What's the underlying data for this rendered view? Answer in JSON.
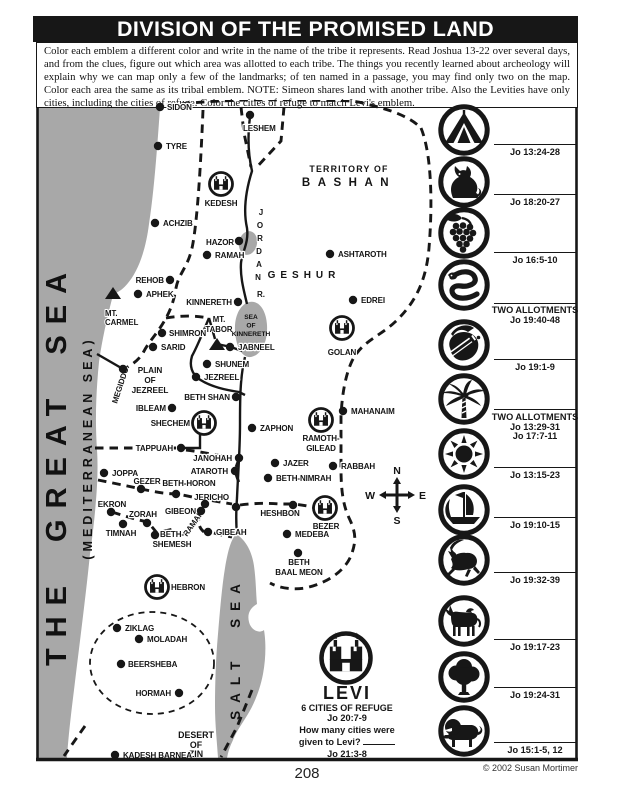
{
  "title": "DIVISION OF THE PROMISED LAND",
  "instructions": "Color each emblem a different color and write in the name of the tribe it represents. Read Joshua 13-22 over several days, and from the clues, figure out which area was allotted to each tribe. The things you recently learned about archeology will explain why we can map only a few of the landmarks; of ten named in a passage, you may find only two on the map.  Color each area the same as its tribal emblem. NOTE: Simeon shares land with another tribe. Also the Levities have only cities, including the cities of refuge. Color the cities of refuge to match Levi's emblem.",
  "footer": {
    "page_number": "208",
    "copyright": "© 2002 Susan Mortimer"
  },
  "colors": {
    "ink": "#171717",
    "sea_gray": "#a8a8a8",
    "paper": "#ffffff"
  },
  "map": {
    "great_sea": {
      "title": "THE  GREAT  SEA",
      "subtitle": "(MEDITERRANEAN   SEA)"
    },
    "salt_sea_label": "SALT  SEA",
    "sea_of_kinnereth": [
      "SEA",
      "OF",
      "KINNERETH"
    ],
    "jordan_letters": [
      [
        "J",
        261,
        215
      ],
      [
        "O",
        260,
        228
      ],
      [
        "R",
        260,
        241
      ],
      [
        "D",
        259,
        254
      ],
      [
        "A",
        259,
        267
      ],
      [
        "N",
        258,
        280
      ],
      [
        "R.",
        261,
        297
      ]
    ],
    "regions": [
      {
        "t": "TERRITORY OF",
        "x": 349,
        "y": 172,
        "s": 8.8,
        "ls": 1.2,
        "a": "middle"
      },
      {
        "t": "BASHAN",
        "x": 349,
        "y": 186,
        "s": 11.5,
        "ls": 7.5,
        "a": "middle"
      },
      {
        "t": "GESHUR",
        "x": 304,
        "y": 278,
        "s": 10,
        "ls": 5,
        "a": "middle"
      },
      {
        "t": "PLAIN",
        "x": 150,
        "y": 373,
        "s": 8.2,
        "ls": 0,
        "a": "middle"
      },
      {
        "t": "OF",
        "x": 150,
        "y": 383,
        "s": 8.2,
        "ls": 0,
        "a": "middle"
      },
      {
        "t": "JEZREEL",
        "x": 150,
        "y": 393,
        "s": 8.2,
        "ls": 0,
        "a": "middle"
      },
      {
        "t": "MT.",
        "x": 105,
        "y": 316,
        "s": 7.8,
        "ls": 0,
        "a": "start"
      },
      {
        "t": "CARMEL",
        "x": 105,
        "y": 325,
        "s": 7.8,
        "ls": 0,
        "a": "start"
      },
      {
        "t": "MT.",
        "x": 219,
        "y": 322,
        "s": 7.8,
        "ls": 0,
        "a": "middle"
      },
      {
        "t": "TABOR",
        "x": 219,
        "y": 332,
        "s": 7.8,
        "ls": 0,
        "a": "middle"
      },
      {
        "t": "DESERT",
        "x": 196,
        "y": 738,
        "s": 8.8,
        "ls": 0,
        "a": "middle"
      },
      {
        "t": "OF",
        "x": 196,
        "y": 748,
        "s": 8.8,
        "ls": 0,
        "a": "middle"
      },
      {
        "t": "ZIN",
        "x": 196,
        "y": 757,
        "s": 8.8,
        "ls": 0,
        "a": "middle"
      }
    ],
    "cities": [
      {
        "n": "SIDON",
        "x": 160,
        "y": 107,
        "lx": 167,
        "ly": 110,
        "a": "start"
      },
      {
        "n": "LESHEM",
        "x": 250,
        "y": 115,
        "lx": 243,
        "ly": 131,
        "a": "start"
      },
      {
        "n": "TYRE",
        "x": 158,
        "y": 146,
        "lx": 166,
        "ly": 149,
        "a": "start"
      },
      {
        "n": "ACHZIB",
        "x": 155,
        "y": 223,
        "lx": 163,
        "ly": 226,
        "a": "start"
      },
      {
        "n": "HAZOR",
        "x": 239,
        "y": 241,
        "lx": 234,
        "ly": 245,
        "a": "end"
      },
      {
        "n": "RAMAH",
        "x": 207,
        "y": 255,
        "lx": 215,
        "ly": 258,
        "a": "start"
      },
      {
        "n": "ASHTAROTH",
        "x": 330,
        "y": 254,
        "lx": 338,
        "ly": 257,
        "a": "start"
      },
      {
        "n": "REHOB",
        "x": 170,
        "y": 280,
        "lx": 164,
        "ly": 283,
        "a": "end"
      },
      {
        "n": "APHEK",
        "x": 138,
        "y": 294,
        "lx": 146,
        "ly": 297,
        "a": "start"
      },
      {
        "n": "EDREI",
        "x": 353,
        "y": 300,
        "lx": 361,
        "ly": 303,
        "a": "start"
      },
      {
        "n": "KINNERETH",
        "x": 238,
        "y": 302,
        "lx": 232,
        "ly": 305,
        "a": "end"
      },
      {
        "n": "SHIMRON",
        "x": 162,
        "y": 333,
        "lx": 169,
        "ly": 336,
        "a": "start"
      },
      {
        "n": "SARID",
        "x": 153,
        "y": 347,
        "lx": 161,
        "ly": 350,
        "a": "start"
      },
      {
        "n": "JABNEEL",
        "x": 230,
        "y": 347,
        "lx": 238,
        "ly": 350,
        "a": "start"
      },
      {
        "n": "SHUNEM",
        "x": 207,
        "y": 364,
        "lx": 215,
        "ly": 367,
        "a": "start"
      },
      {
        "n": "JEZREEL",
        "x": 196,
        "y": 377,
        "lx": 204,
        "ly": 380,
        "a": "start"
      },
      {
        "n": "MEGIDDO",
        "x": 123,
        "y": 369,
        "lx": 117,
        "ly": 404,
        "a": "start",
        "r": -72
      },
      {
        "n": "BETH SHAN",
        "x": 236,
        "y": 397,
        "lx": 230,
        "ly": 400,
        "a": "end"
      },
      {
        "n": "IBLEAM",
        "x": 172,
        "y": 408,
        "lx": 166,
        "ly": 411,
        "a": "end"
      },
      {
        "n": "ZAPHON",
        "x": 252,
        "y": 428,
        "lx": 260,
        "ly": 431,
        "a": "start"
      },
      {
        "n": "MAHANAIM",
        "x": 343,
        "y": 411,
        "lx": 351,
        "ly": 414,
        "a": "start"
      },
      {
        "n": "TAPPUAH",
        "x": 181,
        "y": 448,
        "lx": 173,
        "ly": 451,
        "a": "end"
      },
      {
        "n": "JANOHAH",
        "x": 239,
        "y": 458,
        "lx": 232,
        "ly": 461,
        "a": "end"
      },
      {
        "n": "ATAROTH",
        "x": 235,
        "y": 471,
        "lx": 228,
        "ly": 474,
        "a": "end"
      },
      {
        "n": "JAZER",
        "x": 275,
        "y": 463,
        "lx": 283,
        "ly": 466,
        "a": "start"
      },
      {
        "n": "RABBAH",
        "x": 333,
        "y": 466,
        "lx": 341,
        "ly": 469,
        "a": "start"
      },
      {
        "n": "JOPPA",
        "x": 104,
        "y": 473,
        "lx": 112,
        "ly": 476,
        "a": "start"
      },
      {
        "n": "GEZER",
        "x": 141,
        "y": 489,
        "lx": 147,
        "ly": 484,
        "a": "middle"
      },
      {
        "n": "BETH-HORON",
        "x": 176,
        "y": 494,
        "lx": 189,
        "ly": 486,
        "a": "middle"
      },
      {
        "n": "BETH-NIMRAH",
        "x": 268,
        "y": 478,
        "lx": 276,
        "ly": 481,
        "a": "start"
      },
      {
        "n": "JERICHO",
        "x": 236,
        "y": 507,
        "lx": 229,
        "ly": 500,
        "a": "end"
      },
      {
        "n": "EKRON",
        "x": 111,
        "y": 512,
        "lx": 112,
        "ly": 507,
        "a": "middle"
      },
      {
        "n": "ZORAH",
        "x": 147,
        "y": 523,
        "lx": 143,
        "ly": 517,
        "a": "middle"
      },
      {
        "n": "GIBEON",
        "x": 201,
        "y": 511,
        "lx": 196,
        "ly": 514,
        "a": "end"
      },
      {
        "n": "RAMAH",
        "x": 205,
        "y": 504,
        "lx": 187,
        "ly": 537,
        "a": "start",
        "r": -55
      },
      {
        "n": "HESHBON",
        "x": 293,
        "y": 505,
        "lx": 280,
        "ly": 516,
        "a": "middle"
      },
      {
        "n": "TIMNAH",
        "x": 123,
        "y": 524,
        "lx": 121,
        "ly": 536,
        "a": "middle"
      },
      {
        "n": "BETH-SHEMESH",
        "x": 155,
        "y": 535,
        "a": "middle",
        "lines": [
          [
            "BETH-",
            172,
            537
          ],
          [
            "SHEMESH",
            172,
            547
          ]
        ]
      },
      {
        "n": "GIBEAH",
        "x": 208,
        "y": 532,
        "lx": 216,
        "ly": 535,
        "a": "start"
      },
      {
        "n": "MEDEBA",
        "x": 287,
        "y": 534,
        "lx": 295,
        "ly": 537,
        "a": "start"
      },
      {
        "n": "BETH BAAL MEON",
        "x": 298,
        "y": 553,
        "a": "middle",
        "lines": [
          [
            "BETH",
            299,
            565
          ],
          [
            "BAAL MEON",
            299,
            575
          ]
        ]
      },
      {
        "n": "ZIKLAG",
        "x": 117,
        "y": 628,
        "lx": 125,
        "ly": 631,
        "a": "start"
      },
      {
        "n": "MOLADAH",
        "x": 139,
        "y": 639,
        "lx": 147,
        "ly": 642,
        "a": "start"
      },
      {
        "n": "BEERSHEBA",
        "x": 121,
        "y": 664,
        "lx": 128,
        "ly": 667,
        "a": "start"
      },
      {
        "n": "HORMAH",
        "x": 179,
        "y": 693,
        "lx": 171,
        "ly": 696,
        "a": "end"
      },
      {
        "n": "KADESH BARNEA",
        "x": 115,
        "y": 755,
        "lx": 123,
        "ly": 758,
        "a": "start"
      }
    ],
    "refuge_cities": [
      {
        "n": "KEDESH",
        "x": 221,
        "y": 184,
        "lines": [
          [
            "KEDESH",
            221,
            206
          ]
        ]
      },
      {
        "n": "GOLAN",
        "x": 342,
        "y": 328,
        "lines": [
          [
            "GOLAN",
            342,
            355
          ]
        ]
      },
      {
        "n": "SHECHEM",
        "x": 204,
        "y": 423,
        "lines": [
          [
            "SHECHEM",
            190,
            426
          ]
        ],
        "a": "end"
      },
      {
        "n": "RAMOTH-GILEAD",
        "x": 321,
        "y": 420,
        "lines": [
          [
            "RAMOTH-",
            321,
            441
          ],
          [
            "GILEAD",
            321,
            451
          ]
        ]
      },
      {
        "n": "BEZER",
        "x": 325,
        "y": 508,
        "lines": [
          [
            "BEZER",
            326,
            529
          ]
        ]
      },
      {
        "n": "HEBRON",
        "x": 157,
        "y": 587,
        "lines": [
          [
            "HEBRON",
            171,
            590
          ]
        ],
        "a": "start"
      }
    ],
    "mountains": [
      {
        "x": 113,
        "y": 294
      },
      {
        "x": 217,
        "y": 345
      }
    ],
    "compass": {
      "n": "N",
      "w": "W",
      "e": "E",
      "s": "S",
      "x": 397,
      "y": 495
    }
  },
  "emblems": [
    {
      "icon": "tent-icon",
      "cy": 130,
      "line_y": 144,
      "texts": [
        {
          "t": "Jo 13:24-28",
          "y": 155
        }
      ]
    },
    {
      "icon": "wolf-icon",
      "cy": 182,
      "line_y": 194,
      "texts": [
        {
          "t": "Jo 18:20-27",
          "y": 205
        }
      ]
    },
    {
      "icon": "grapes-icon",
      "cy": 233,
      "line_y": 252,
      "texts": [
        {
          "t": "Jo 16:5-10",
          "y": 263
        }
      ]
    },
    {
      "icon": "snake-icon",
      "cy": 285,
      "line_y": 303,
      "texts": [
        {
          "t": "TWO ALLOTMENTS",
          "y": 313
        },
        {
          "t": "Jo 19:40-48",
          "y": 323
        }
      ]
    },
    {
      "icon": "sword-icon",
      "cy": 345,
      "line_y": 359,
      "texts": [
        {
          "t": "Jo 19:1-9",
          "y": 370
        }
      ]
    },
    {
      "icon": "palm-tree-icon",
      "cy": 399,
      "line_y": 409,
      "texts": [
        {
          "t": "TWO ALLOTMENTS",
          "y": 420
        },
        {
          "t": "Jo 13:29-31",
          "y": 430
        },
        {
          "t": "Jo 17:7-11",
          "y": 439
        }
      ]
    },
    {
      "icon": "sun-icon",
      "cy": 454,
      "line_y": 467,
      "texts": [
        {
          "t": "Jo 13:15-23",
          "y": 478
        }
      ]
    },
    {
      "icon": "ship-icon",
      "cy": 510,
      "line_y": 517,
      "texts": [
        {
          "t": "Jo 19:10-15",
          "y": 528
        }
      ]
    },
    {
      "icon": "deer-icon",
      "cy": 560,
      "line_y": 572,
      "texts": [
        {
          "t": "Jo 19:32-39",
          "y": 583
        }
      ]
    },
    {
      "icon": "donkey-icon",
      "cy": 621,
      "line_y": 639,
      "texts": [
        {
          "t": "Jo 19:17-23",
          "y": 650
        }
      ]
    },
    {
      "icon": "tree-icon",
      "cy": 677,
      "line_y": 687,
      "texts": [
        {
          "t": "Jo 19:24-31",
          "y": 698
        }
      ]
    },
    {
      "icon": "lion-icon",
      "cy": 731,
      "line_y": 742,
      "texts": [
        {
          "t": "Jo 15:1-5, 12",
          "y": 753
        }
      ]
    }
  ],
  "levi": {
    "name": "LEVI",
    "line1": "6 CITIES OF REFUGE",
    "line2": "Jo 20:7-9",
    "line3": "How many cities were",
    "line4": "given to Levi?",
    "line5": "Jo 21:3-8"
  }
}
